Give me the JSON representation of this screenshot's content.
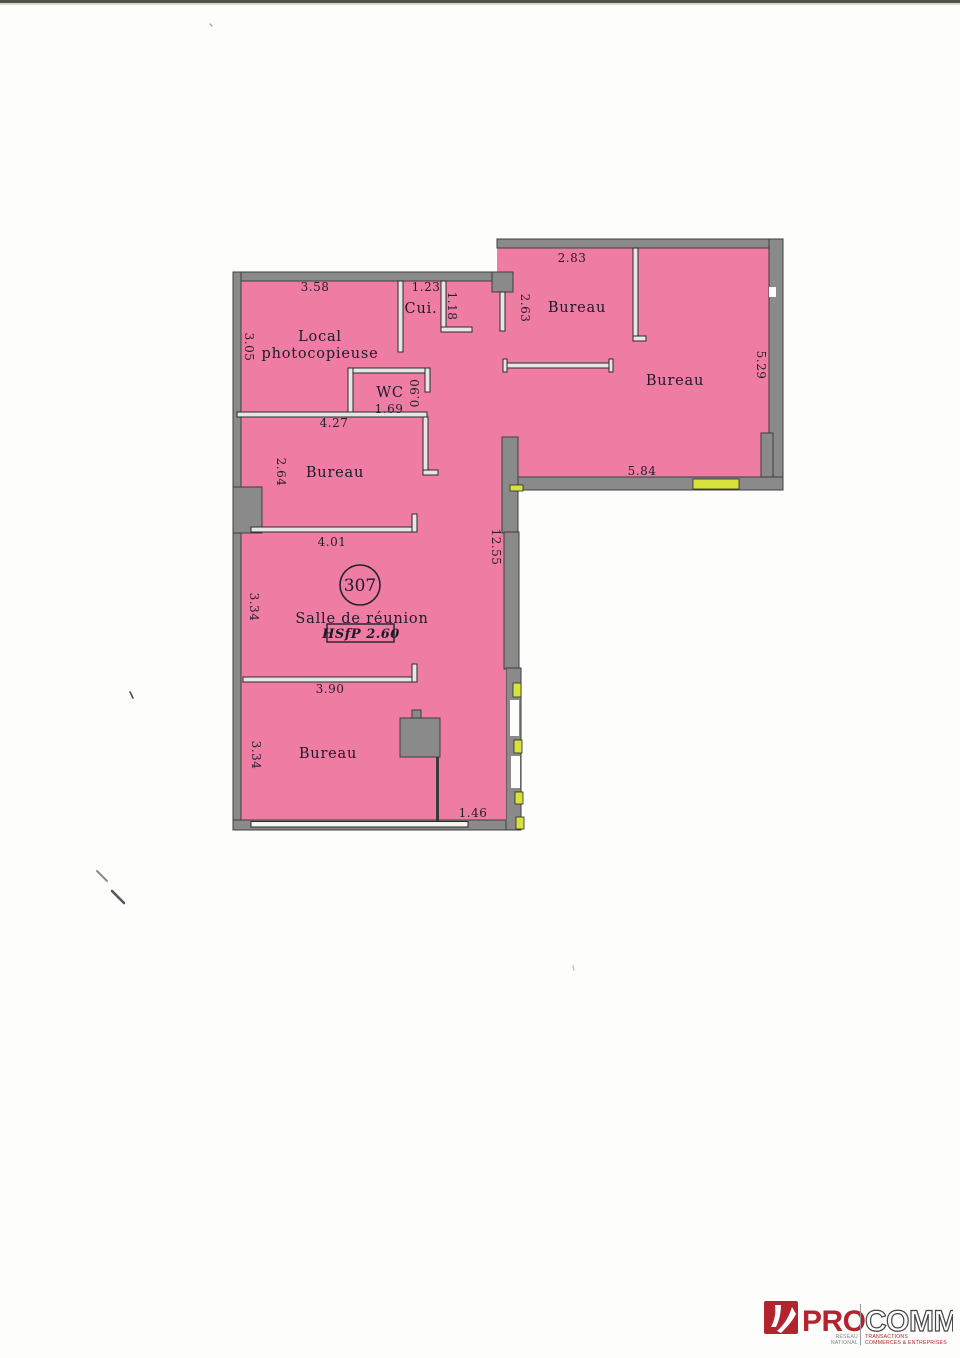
{
  "document": {
    "type_label": "floor-plan-scan",
    "colors": {
      "room_fill": "#ef7da3",
      "wall_gray": "#8a8a8a",
      "partition_light": "#e6e6e6",
      "window_yellow": "#d9e23c",
      "line_dark": "#2a2a2a",
      "text_dark": "#1f1f2b",
      "logo_red": "#b3242e",
      "logo_outline": "#45454a",
      "scan_edge": "#52524a"
    }
  },
  "plan": {
    "unit": {
      "number": "307",
      "ceiling_height": "HSfP 2.60"
    },
    "rooms": {
      "local_photocopieuse": {
        "name_line1": "Local",
        "name_line2": "photocopieuse"
      },
      "cuisine": {
        "name": "Cui."
      },
      "wc": {
        "name": "WC"
      },
      "bureau_left": {
        "name": "Bureau"
      },
      "salle_de_reunion": {
        "name": "Salle de réunion"
      },
      "bureau_bottom": {
        "name": "Bureau"
      },
      "bureau_top": {
        "name": "Bureau"
      },
      "bureau_right": {
        "name": "Bureau"
      }
    },
    "dims": {
      "local_width": "3.58",
      "local_depth": "3.05",
      "cui_width": "1.23",
      "cui_depth": "1.18",
      "hall_depth": "2.63",
      "wc_width": "1.69",
      "wc_door": "0.90",
      "bureau_left_width": "4.27",
      "bureau_left_depth": "2.64",
      "salle_top_width": "4.01",
      "corridor_length": "12.55",
      "salle_depth": "3.34",
      "salle_bottom_width": "3.90",
      "bureau_bottom_depth": "3.34",
      "recess_width": "1.46",
      "bureau_top_width": "2.83",
      "bureau_right_width": "5.84",
      "bureau_right_depth": "5.29"
    }
  },
  "logo": {
    "brand_primary": "PRO",
    "brand_secondary": "COMM",
    "network_line1": "RÉSEAU",
    "network_line2": "NATIONAL",
    "tagline_line1": "TRANSACTIONS",
    "tagline_line2": "COMMERCES & ENTREPRISES"
  }
}
